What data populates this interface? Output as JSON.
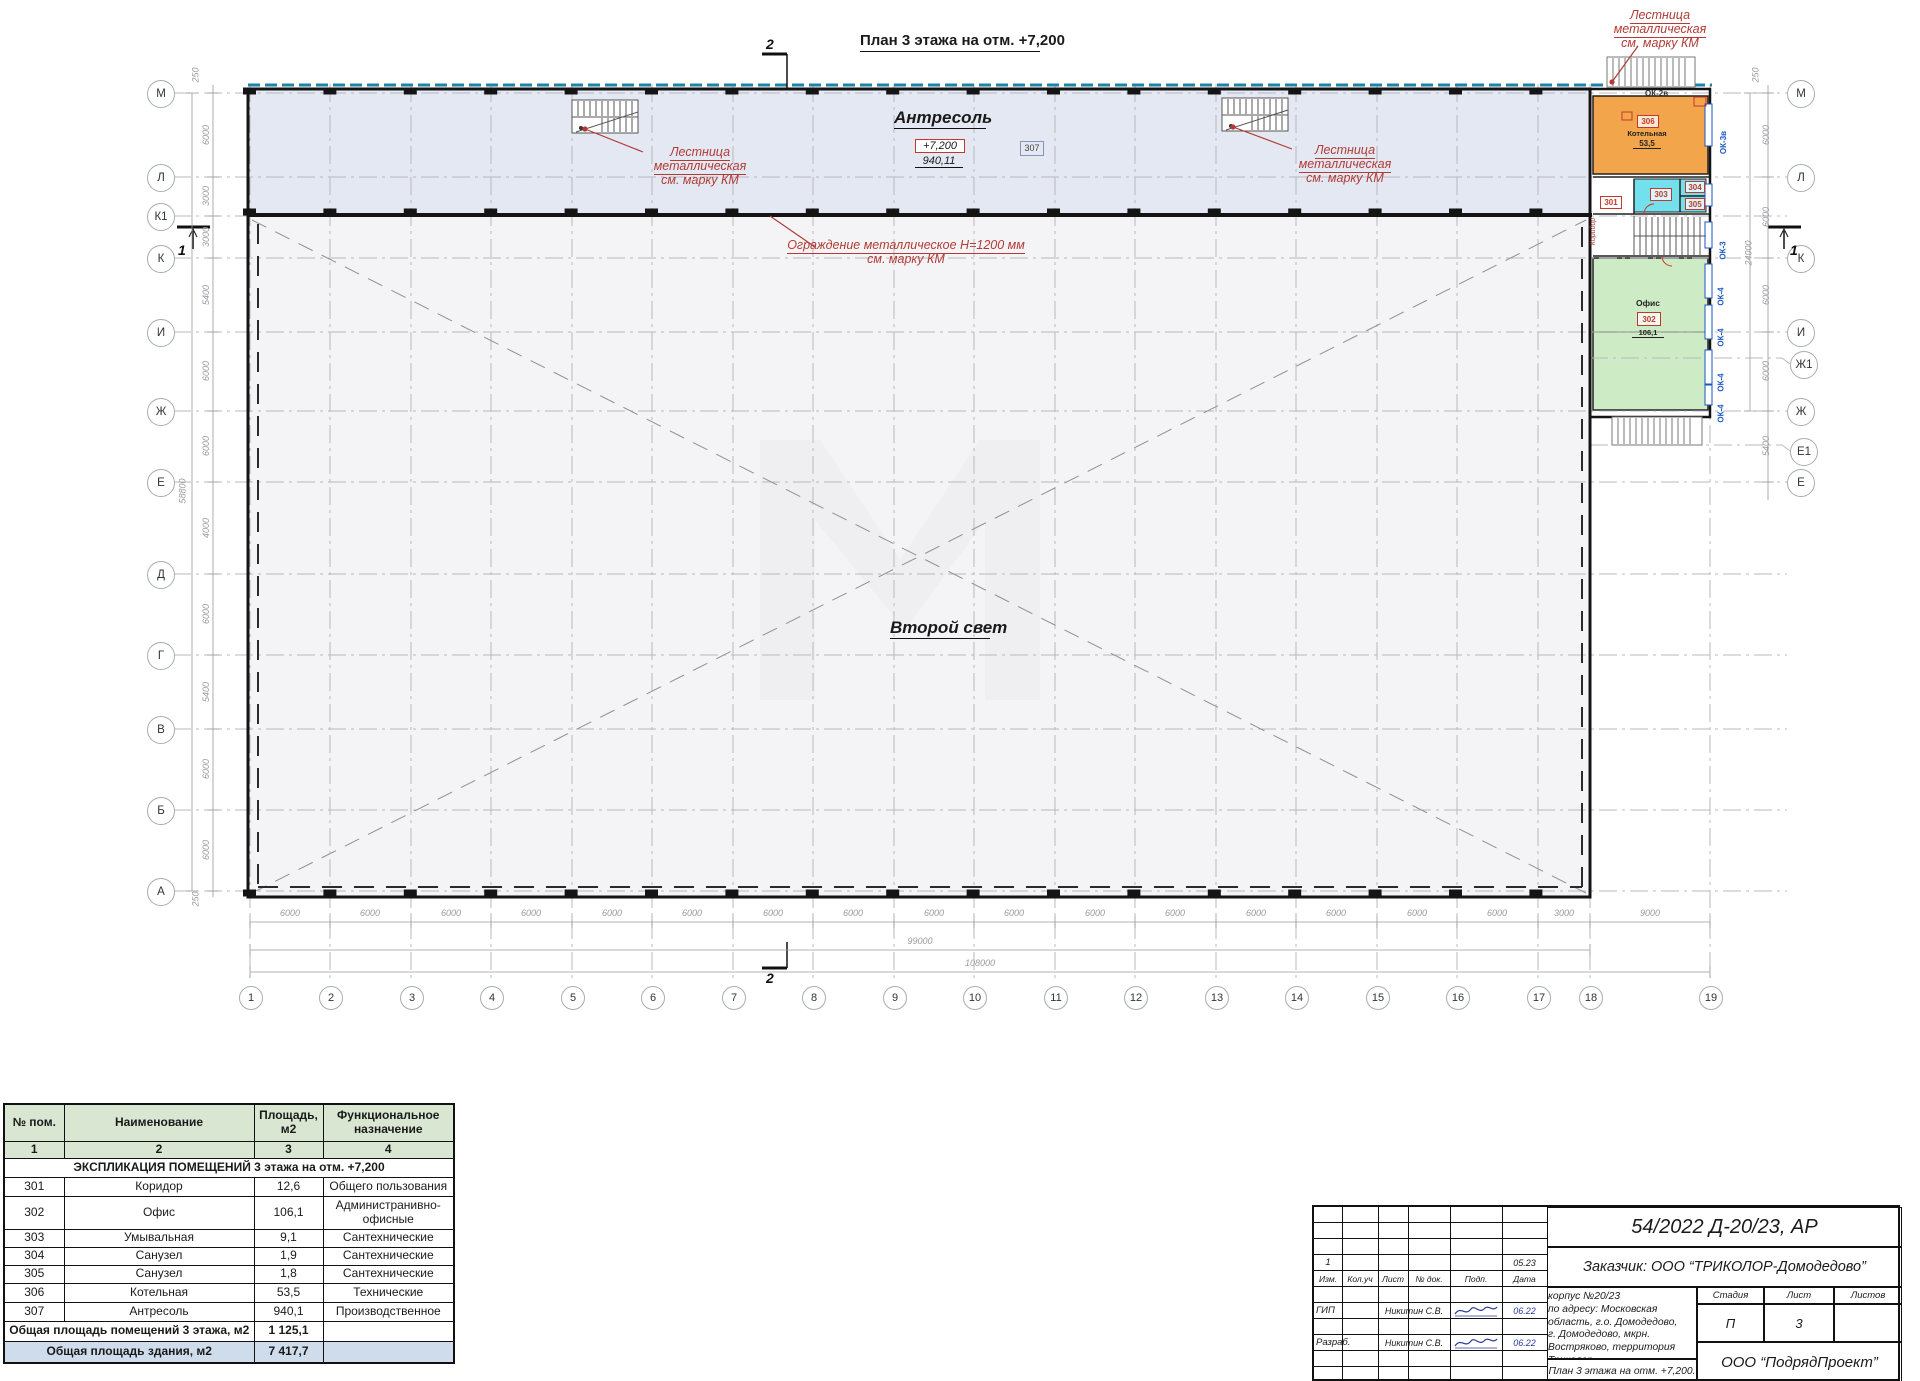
{
  "plan": {
    "title": "План 3 этажа на отм. +7,200",
    "antresol": {
      "label": "Антресоль",
      "elev": "+7,200",
      "area": "940,11",
      "tag": "307"
    },
    "second_light": "Второй свет",
    "note_stair_l1": "Лестница металлическая",
    "note_stair_l2": "см. марку КМ",
    "note_rail_l1": "Ограждение металлическое Н=1200 мм",
    "note_rail_l2": "см. марку КМ",
    "section": {
      "top": "2",
      "bottom": "2",
      "left": "1",
      "right": "1"
    }
  },
  "axes": {
    "bottom": [
      "1",
      "2",
      "3",
      "4",
      "5",
      "6",
      "7",
      "8",
      "9",
      "10",
      "11",
      "12",
      "13",
      "14",
      "15",
      "16",
      "17",
      "18",
      "19"
    ],
    "left": [
      "М",
      "Л",
      "К1",
      "К",
      "И",
      "Ж",
      "Е",
      "Д",
      "Г",
      "В",
      "Б",
      "А"
    ],
    "right": [
      "М",
      "Л",
      "К",
      "И",
      "Ж1",
      "Ж",
      "Е1",
      "Е"
    ]
  },
  "dims": {
    "bays": [
      "6000",
      "6000",
      "6000",
      "6000",
      "6000",
      "6000",
      "6000",
      "6000",
      "6000",
      "6000",
      "6000",
      "6000",
      "6000",
      "6000",
      "6000",
      "6000",
      "3000",
      "9000"
    ],
    "total_1_18": "99000",
    "total_1_19": "108000",
    "left": [
      "250",
      "6000",
      "3000",
      "3000",
      "5400",
      "6000",
      "6000",
      "4000",
      "6000",
      "5400",
      "6000",
      "6000",
      "250"
    ],
    "left_total": "58800",
    "right": [
      "250",
      "6000",
      "6000",
      "6000",
      "6000",
      "5400"
    ],
    "right_total": "24000"
  },
  "rooms": {
    "boiler": {
      "tag": "306",
      "name": "Котельная",
      "area": "53,5"
    },
    "washroom": {
      "tag": "303"
    },
    "wc304": {
      "tag": "304"
    },
    "wc305": {
      "tag": "305"
    },
    "corridor": {
      "tag": "301",
      "name": "Коридор"
    },
    "office": {
      "tag": "302",
      "name": "Офис",
      "area": "106,1"
    }
  },
  "windows": {
    "ok2v": "ОК-2в",
    "ok3v": "ОК-3в",
    "ok3": "ОК-3",
    "ok4": "ОК-4"
  },
  "schedule": {
    "h_num": "№ пом.",
    "h_name": "Наименование",
    "h_area": "Площадь, м2",
    "h_func": "Функциональное назначение",
    "col_nums": [
      "1",
      "2",
      "3",
      "4"
    ],
    "section_title": "ЭКСПЛИКАЦИЯ ПОМЕЩЕНИЙ 3 этажа на отм. +7,200",
    "rows": [
      {
        "num": "301",
        "name": "Коридор",
        "area": "12,6",
        "func": "Общего пользования"
      },
      {
        "num": "302",
        "name": "Офис",
        "area": "106,1",
        "func": "Администранивно-офисные"
      },
      {
        "num": "303",
        "name": "Умывальная",
        "area": "9,1",
        "func": "Сантехнические"
      },
      {
        "num": "304",
        "name": "Санузел",
        "area": "1,9",
        "func": "Сантехнические"
      },
      {
        "num": "305",
        "name": "Санузел",
        "area": "1,8",
        "func": "Сантехнические"
      },
      {
        "num": "306",
        "name": "Котельная",
        "area": "53,5",
        "func": "Технические"
      },
      {
        "num": "307",
        "name": "Антресоль",
        "area": "940,1",
        "func": "Производственное"
      }
    ],
    "total_floor_label": "Общая площадь помещений 3 этажа, м2",
    "total_floor_value": "1 125,1",
    "total_building_label": "Общая площадь здания, м2",
    "total_building_value": "7 417,7"
  },
  "titleblock": {
    "doc_number": "54/2022 Д-20/23, АР",
    "client": "Заказчик: ООО “ТРИКОЛОР-Домодедово”",
    "project_l1": "Производственно-складской корпус №20/23",
    "project_l2": "по адресу: Московская область, г.о. Домодедово,",
    "project_l3": "г. Домодедово, мкрн. Востряково, территория Триколор.",
    "sheet_title": "План 3 этажа на отм. +7,200.",
    "company": "ООО “ПодрядПроект”",
    "stage_label": "Стадия",
    "sheet_label": "Лист",
    "sheets_label": "Листов",
    "stage": "П",
    "sheet": "3",
    "sheets": "",
    "rev_h": [
      "Изм.",
      "Кол.уч",
      "Лист",
      "№ док.",
      "Подп.",
      "Дата"
    ],
    "rev_num": "1",
    "rev_date": "05.23",
    "role1": "ГИП",
    "name1": "Никитин С.В.",
    "date1": "06.22",
    "role2": "Разраб.",
    "name2": "Никитин С.В.",
    "date2": "06.22"
  }
}
